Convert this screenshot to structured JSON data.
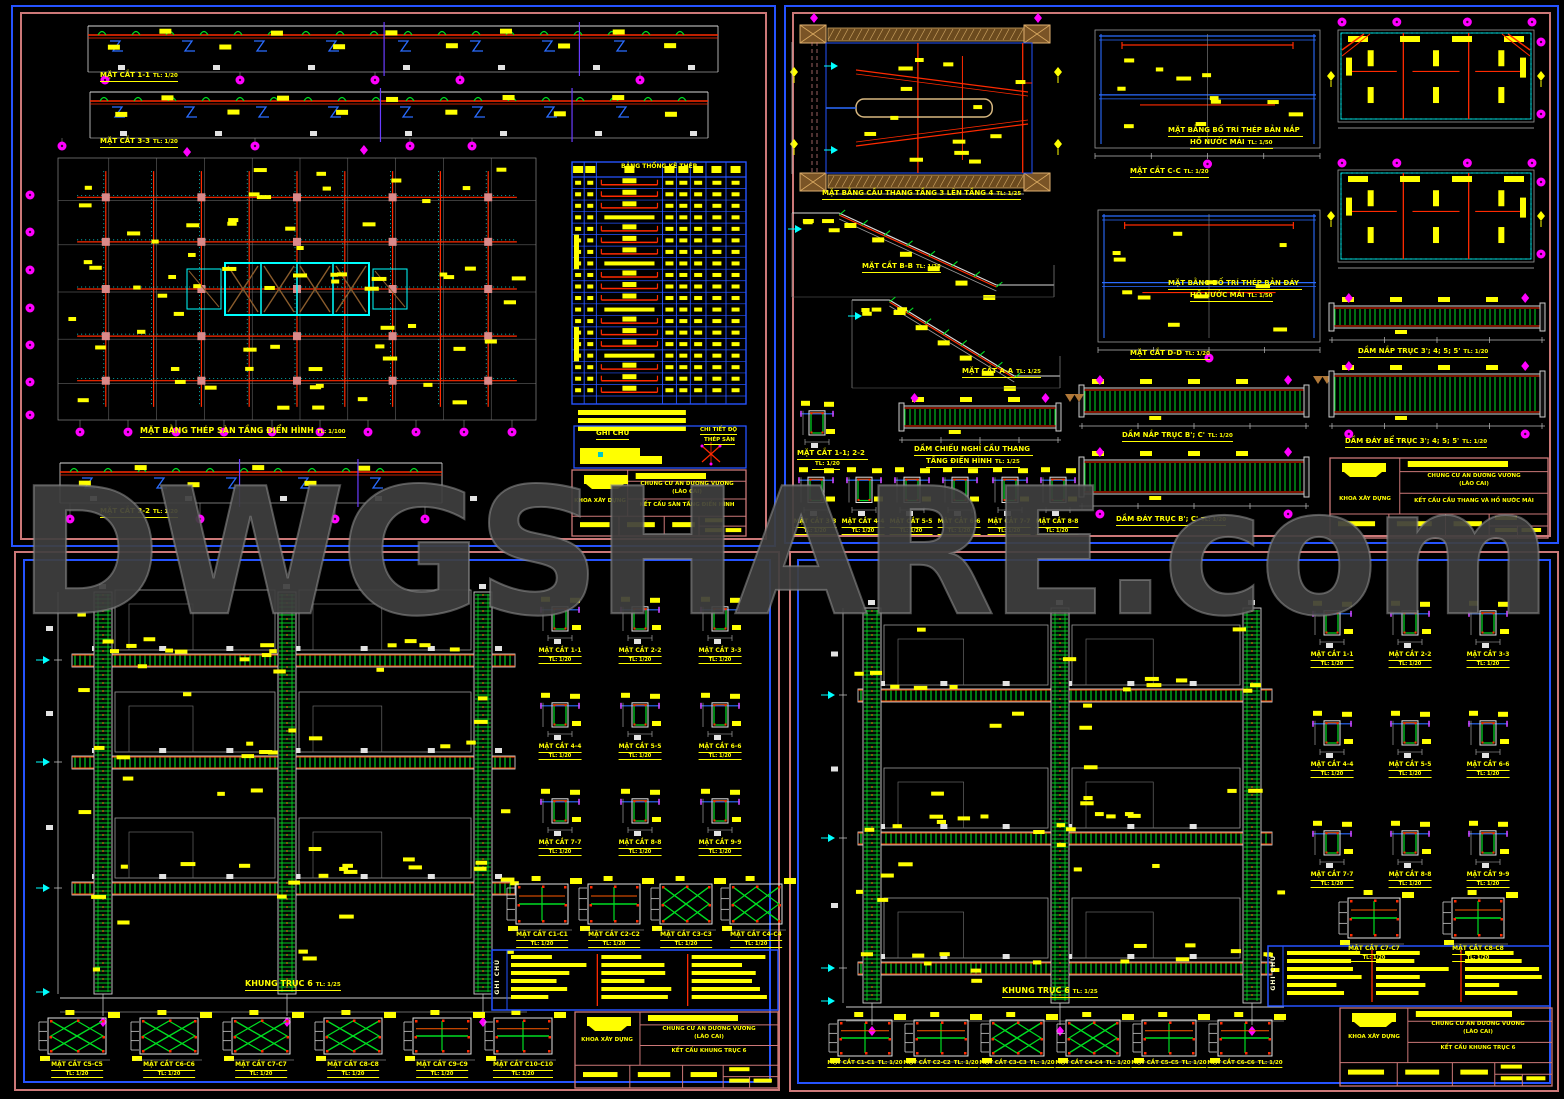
{
  "watermark": {
    "text": "DWGSHARE.com"
  },
  "colors": {
    "background": "#000000",
    "sheet_border_outer_blue": "#2553ff",
    "sheet_border_salmon": "#cc7878",
    "label_yellow": "#ffff00",
    "rebar_red": "#ff2a00",
    "stirrup_green": "#00dd22",
    "grid_cyan": "#00ffff",
    "bubble_magenta": "#ff00ff",
    "line_white": "#d8d8d8",
    "hatch_brown": "#9a6a35",
    "watermark_gray": "#3e3e3e"
  },
  "panels": [
    {
      "name": "typical-floor-slab-sheet",
      "labels": [
        {
          "t": "MẶT CẮT 1-1",
          "s": "TL: 1/20"
        },
        {
          "t": "MẶT CẮT 3-3",
          "s": "TL: 1/20"
        },
        {
          "t": "MẶT BẰNG THÉP SÀN TẦNG ĐIỂN HÌNH",
          "s": "TL: 1/100"
        },
        {
          "t": "MẶT CẮT 2-2",
          "s": "TL: 1/20"
        }
      ],
      "table_title": "BẢNG THỐNG KÊ THÉP",
      "notes_title": "GHI CHÚ",
      "notes_detail_1": "CHI TIẾT ĐỘ",
      "notes_detail_2": "THÉP SÀN",
      "title_block": {
        "org": "KHOA XÂY DỰNG",
        "project_1": "CHUNG CƯ AN DƯƠNG VƯƠNG",
        "project_2": "(LÀO CAI)",
        "sheet_title": "KẾT CẤU SÀN TẦNG ĐIỂN HÌNH"
      }
    },
    {
      "name": "staircase-water-tank-sheet",
      "labels": [
        {
          "t": "MẶT BẰNG CẦU THANG TẦNG 3 LÊN TẦNG 4",
          "s": "TL: 1/25"
        },
        {
          "t": "MẶT CẮT C-C",
          "s": "TL: 1/20"
        },
        {
          "t": "MẶT BẰNG BỐ TRÍ THÉP BẢN NẮP"
        },
        {
          "t": "HỒ NƯỚC MÁI",
          "s": "TL: 1/50"
        },
        {
          "t": "MẶT CẮT B-B",
          "s": "TL: 1/25"
        },
        {
          "t": "MẶT CẮT D-D",
          "s": "TL: 1/20"
        },
        {
          "t": "MẶT BẰNG BỐ TRÍ THÉP BẢN ĐÁY"
        },
        {
          "t": "HỒ NƯỚC MÁI",
          "s": "TL: 1/50"
        },
        {
          "t": "MẶT CẮT A-A",
          "s": "TL: 1/25"
        },
        {
          "t": "DẦM NẮP TRỤC 3'; 4; 5; 5'",
          "s": "TL: 1/20"
        },
        {
          "t": "DẦM NẮP TRỤC B'; C'",
          "s": "TL: 1/20"
        },
        {
          "t": "DẦM ĐÁY BỂ TRỤC 3'; 4; 5; 5'",
          "s": "TL: 1/20"
        },
        {
          "t": "MẶT CẮT 1-1; 2-2"
        },
        {
          "s": "TL: 1/20"
        },
        {
          "t": "DẦM CHIẾU NGHỈ CẦU THANG"
        },
        {
          "t": "TẦNG ĐIỂN HÌNH",
          "s": "TL: 1/25"
        },
        {
          "t": "MẶT CẮT 3-3",
          "s": "TL: 1/20"
        },
        {
          "t": "MẶT CẮT 4-4",
          "s": "TL: 1/20"
        },
        {
          "t": "MẶT CẮT 5-5",
          "s": "TL: 1/20"
        },
        {
          "t": "MẶT CẮT 6-6",
          "s": "TL: 1/20"
        },
        {
          "t": "MẶT CẮT 7-7",
          "s": "TL: 1/20"
        },
        {
          "t": "MẶT CẮT 8-8",
          "s": "TL: 1/20"
        },
        {
          "t": "DẦM ĐÁY TRỤC B'; C'",
          "s": "TL: 1/20"
        }
      ],
      "title_block": {
        "org": "KHOA XÂY DỰNG",
        "project_1": "CHUNG CƯ AN DƯƠNG VƯƠNG",
        "project_2": "(LÀO CAI)",
        "sheet_title": "KẾT CẤU CẦU THANG VÀ HỒ NƯỚC MÁI"
      }
    },
    {
      "name": "frame-axis-6-sheet-left",
      "labels": [
        {
          "t": "KHUNG TRỤC 6",
          "s": "TL: 1/25"
        },
        {
          "t": "MẶT CẮT 1-1",
          "s": "TL: 1/20"
        },
        {
          "t": "MẶT CẮT 2-2",
          "s": "TL: 1/20"
        },
        {
          "t": "MẶT CẮT 3-3",
          "s": "TL: 1/20"
        },
        {
          "t": "MẶT CẮT 4-4",
          "s": "TL: 1/20"
        },
        {
          "t": "MẶT CẮT 5-5",
          "s": "TL: 1/20"
        },
        {
          "t": "MẶT CẮT 6-6",
          "s": "TL: 1/20"
        },
        {
          "t": "MẶT CẮT 7-7",
          "s": "TL: 1/20"
        },
        {
          "t": "MẶT CẮT 8-8",
          "s": "TL: 1/20"
        },
        {
          "t": "MẶT CẮT 9-9",
          "s": "TL: 1/20"
        },
        {
          "t": "MẶT CẮT C1-C1",
          "s": "TL: 1/20"
        },
        {
          "t": "MẶT CẮT C2-C2",
          "s": "TL: 1/20"
        },
        {
          "t": "MẶT CẮT C3-C3",
          "s": "TL: 1/20"
        },
        {
          "t": "MẶT CẮT C4-C4",
          "s": "TL: 1/20"
        },
        {
          "t": "MẶT CẮT C5-C5",
          "s": "TL: 1/20"
        },
        {
          "t": "MẶT CẮT C6-C6",
          "s": "TL: 1/20"
        },
        {
          "t": "MẶT CẮT C7-C7",
          "s": "TL: 1/20"
        },
        {
          "t": "MẶT CẮT C8-C8",
          "s": "TL: 1/20"
        },
        {
          "t": "MẶT CẮT C9-C9",
          "s": "TL: 1/20"
        },
        {
          "t": "MẶT CẮT C10-C10",
          "s": "TL: 1/20"
        }
      ],
      "notes_title": "GHI CHÚ",
      "title_block": {
        "org": "KHOA XÂY DỰNG",
        "project_1": "CHUNG CƯ AN DƯƠNG VƯƠNG",
        "project_2": "(LÀO CAI)",
        "sheet_title": "KẾT CẤU KHUNG TRỤC 6"
      }
    },
    {
      "name": "frame-axis-6-sheet-right",
      "labels": [
        {
          "t": "KHUNG TRỤC 6",
          "s": "TL: 1/25"
        },
        {
          "t": "MẶT CẮT 1-1",
          "s": "TL: 1/20"
        },
        {
          "t": "MẶT CẮT 2-2",
          "s": "TL: 1/20"
        },
        {
          "t": "MẶT CẮT 3-3",
          "s": "TL: 1/20"
        },
        {
          "t": "MẶT CẮT 4-4",
          "s": "TL: 1/20"
        },
        {
          "t": "MẶT CẮT 5-5",
          "s": "TL: 1/20"
        },
        {
          "t": "MẶT CẮT 6-6",
          "s": "TL: 1/20"
        },
        {
          "t": "MẶT CẮT 7-7",
          "s": "TL: 1/20"
        },
        {
          "t": "MẶT CẮT 8-8",
          "s": "TL: 1/20"
        },
        {
          "t": "MẶT CẮT 9-9",
          "s": "TL: 1/20"
        },
        {
          "t": "MẶT CẮT C7-C7",
          "s": "TL: 1/20"
        },
        {
          "t": "MẶT CẮT C8-C8",
          "s": "TL: 1/20"
        },
        {
          "t": "MẶT CẮT C1-C1",
          "s": "TL: 1/20"
        },
        {
          "t": "MẶT CẮT C2-C2",
          "s": "TL: 1/20"
        },
        {
          "t": "MẶT CẮT C3-C3",
          "s": "TL: 1/20"
        },
        {
          "t": "MẶT CẮT C4-C4",
          "s": "TL: 1/20"
        },
        {
          "t": "MẶT CẮT C5-C5",
          "s": "TL: 1/20"
        },
        {
          "t": "MẶT CẮT C6-C6",
          "s": "TL: 1/20"
        }
      ],
      "notes_title": "GHI CHÚ",
      "title_block": {
        "org": "KHOA XÂY DỰNG",
        "project_1": "CHUNG CƯ AN DƯƠNG VƯƠNG",
        "project_2": "(LÀO CAI)",
        "sheet_title": "KẾT CẤU KHUNG TRỤC 6"
      }
    }
  ]
}
